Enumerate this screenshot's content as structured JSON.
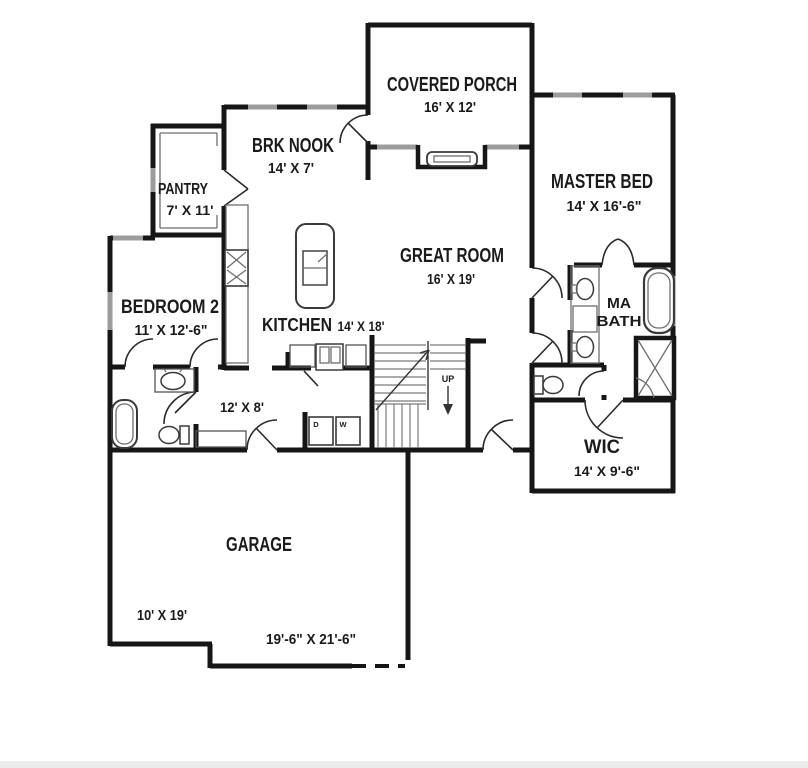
{
  "plan_title": "First floor plan",
  "colors": {
    "wall": "#161616",
    "window": "#9c9c9c",
    "text": "#1b1b1b",
    "background": "#ffffff"
  },
  "rooms": [
    {
      "id": "covered-porch",
      "name": "COVERED PORCH",
      "dims": "16' X 12'"
    },
    {
      "id": "brk-nook",
      "name": "BRK NOOK",
      "dims": "14' X 7'"
    },
    {
      "id": "pantry",
      "name": "PANTRY",
      "dims": "7' X 11'"
    },
    {
      "id": "master-bed",
      "name": "MASTER BED",
      "dims": "14' X 16'-6\""
    },
    {
      "id": "great-room",
      "name": "GREAT ROOM",
      "dims": "16' X 19'"
    },
    {
      "id": "bedroom-2",
      "name": "BEDROOM 2",
      "dims": "11' X 12'-6\""
    },
    {
      "id": "kitchen",
      "name": "KITCHEN",
      "dims": "14' X 18'"
    },
    {
      "id": "hall",
      "name": "",
      "dims": "12' X 8'"
    },
    {
      "id": "ma-bath",
      "name_lines": [
        "MA",
        "BATH"
      ]
    },
    {
      "id": "wic",
      "name": "WIC",
      "dims": "14' X 9'-6\""
    },
    {
      "id": "garage",
      "name": "GARAGE",
      "dims": "19'-6\" X 21'-6\"",
      "dims2": "10' X 19'"
    }
  ],
  "annotations": {
    "stairs_up": "UP",
    "dryer": "D",
    "washer": "W"
  }
}
